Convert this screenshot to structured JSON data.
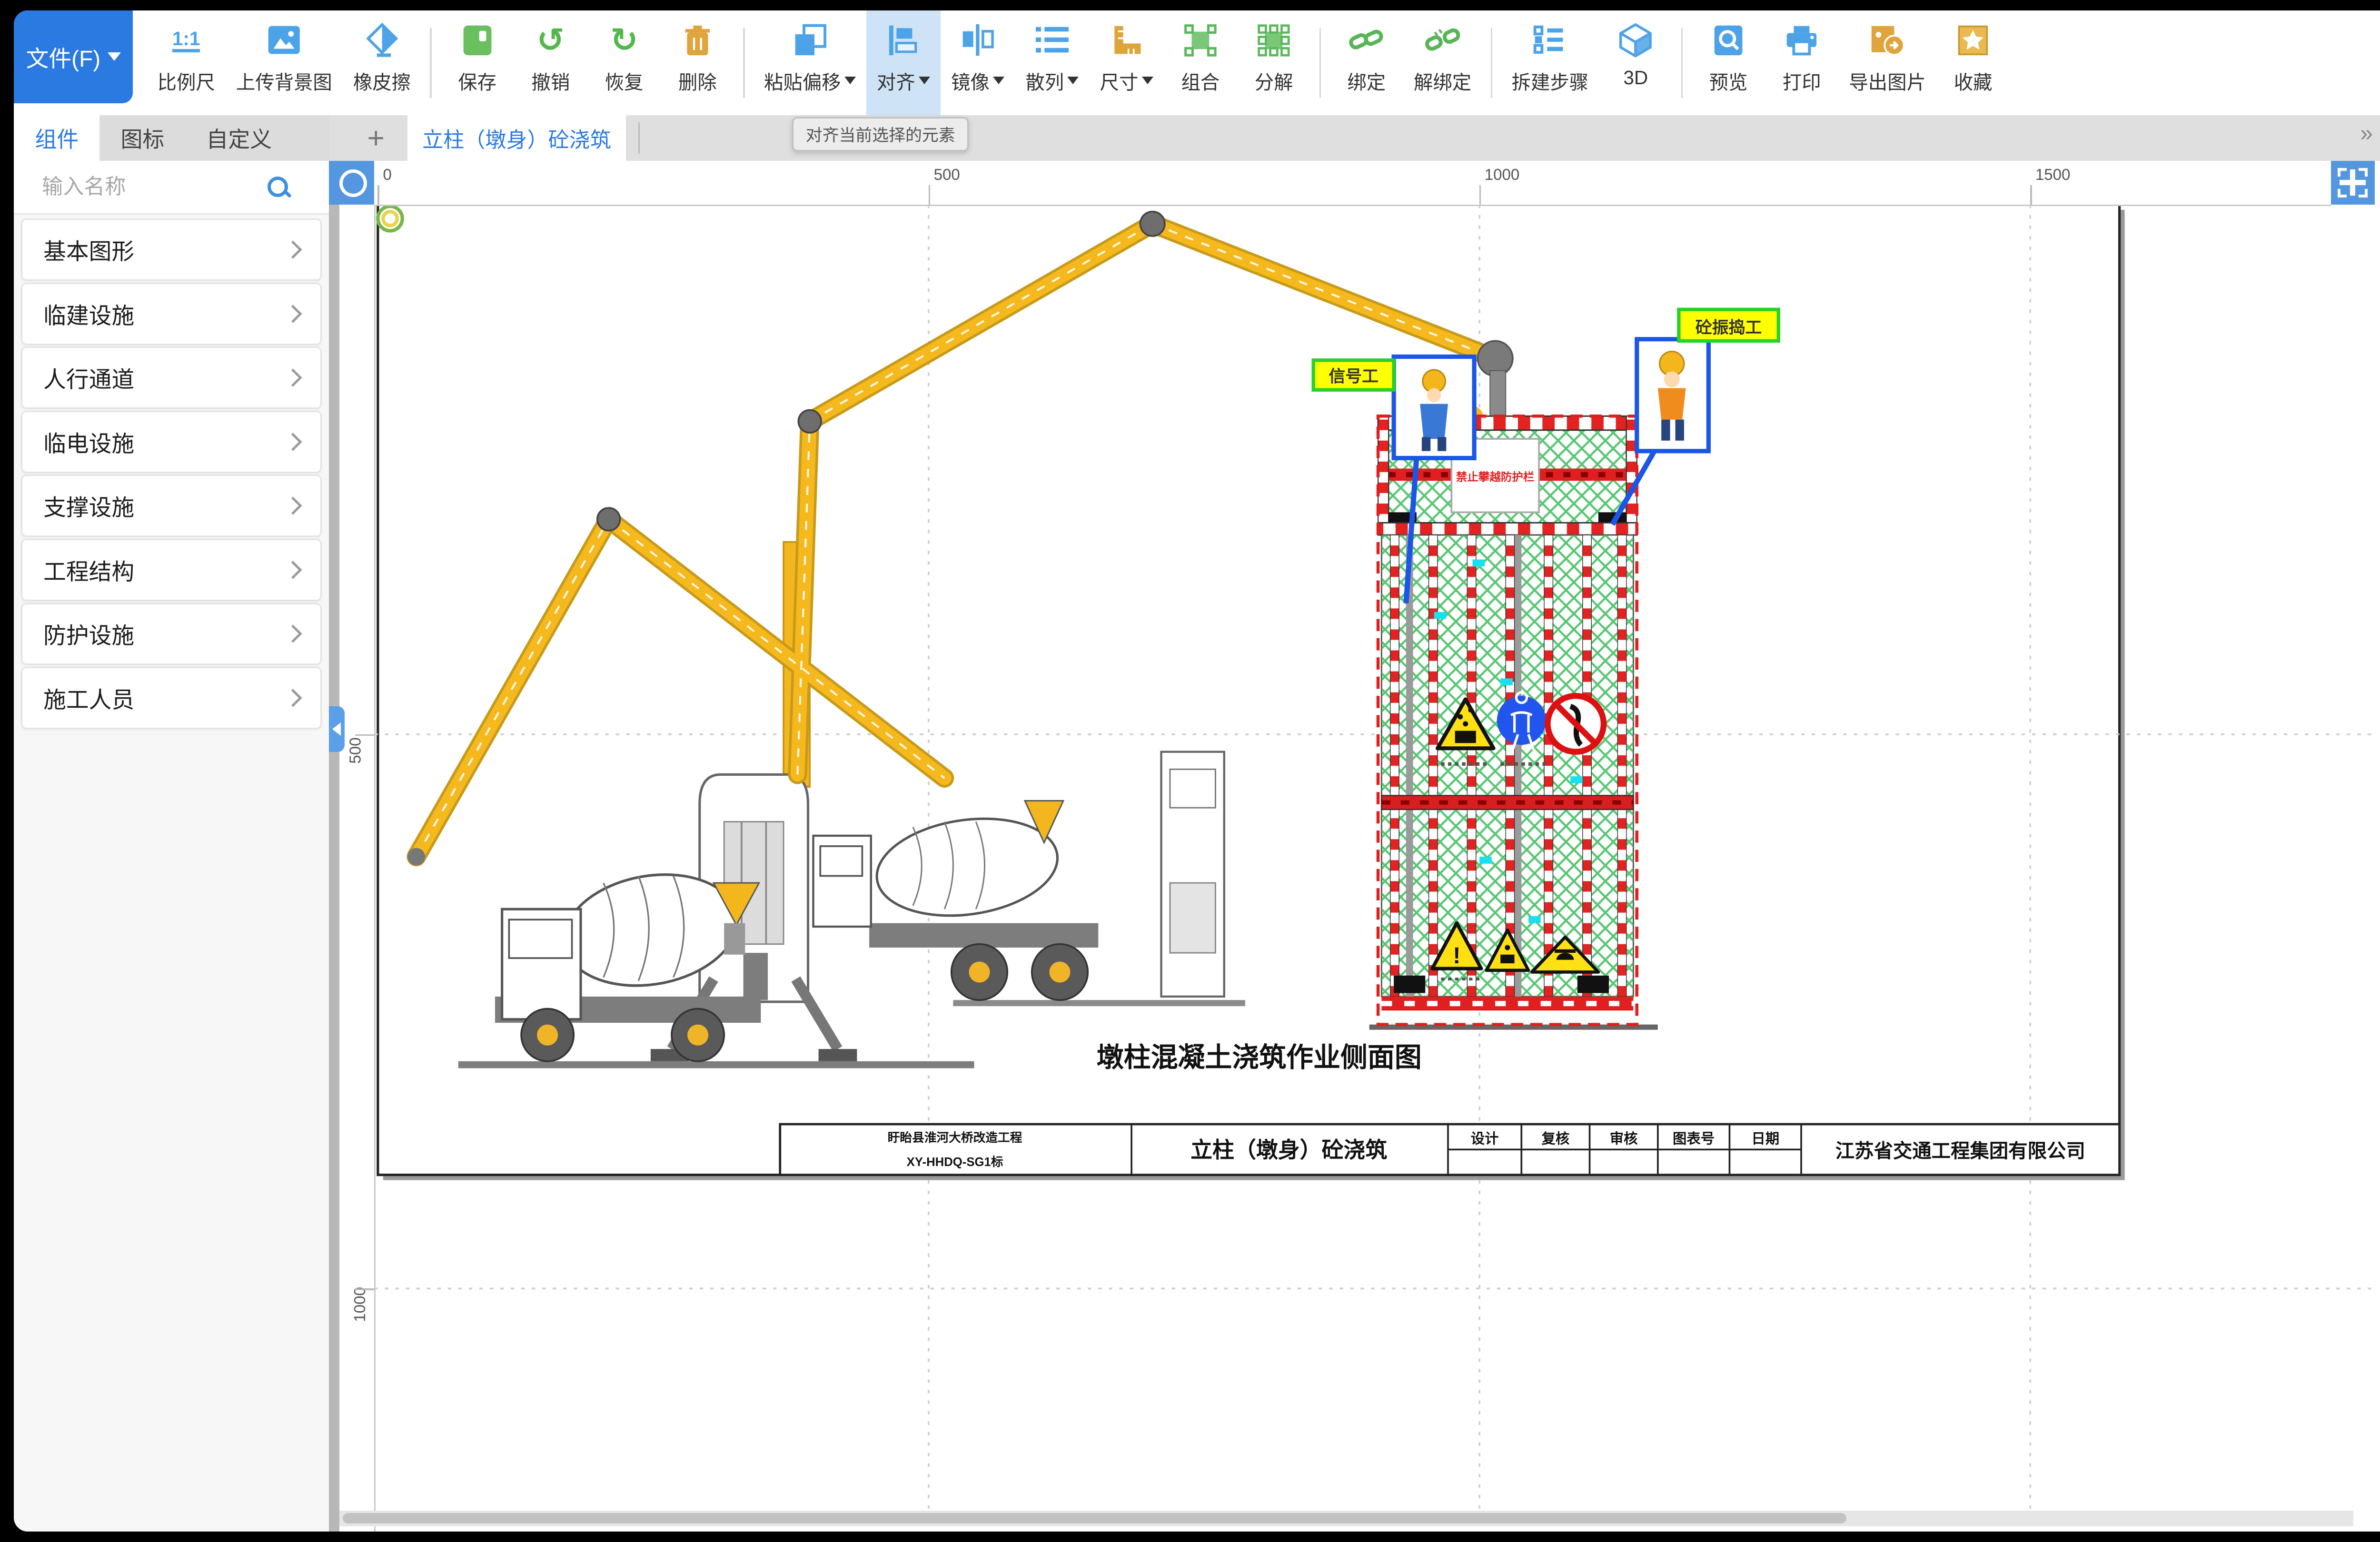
{
  "toolbar": {
    "file_button": "文件(F)",
    "groups": [
      [
        {
          "icon": "scale11",
          "label": "比例尺"
        },
        {
          "icon": "upload-bg",
          "label": "上传背景图"
        },
        {
          "icon": "eraser",
          "label": "橡皮擦"
        }
      ],
      [
        {
          "icon": "save",
          "label": "保存"
        },
        {
          "icon": "undo",
          "label": "撤销"
        },
        {
          "icon": "redo",
          "label": "恢复"
        },
        {
          "icon": "trash",
          "label": "删除"
        }
      ],
      [
        {
          "icon": "paste-offset",
          "label": "粘贴偏移",
          "dropdown": true
        },
        {
          "icon": "align",
          "label": "对齐",
          "dropdown": true,
          "active": true
        },
        {
          "icon": "mirror",
          "label": "镜像",
          "dropdown": true
        },
        {
          "icon": "scatter",
          "label": "散列",
          "dropdown": true
        },
        {
          "icon": "size",
          "label": "尺寸",
          "dropdown": true
        },
        {
          "icon": "group",
          "label": "组合"
        },
        {
          "icon": "ungroup",
          "label": "分解"
        }
      ],
      [
        {
          "icon": "bind",
          "label": "绑定"
        },
        {
          "icon": "unbind",
          "label": "解绑定"
        }
      ],
      [
        {
          "icon": "steps",
          "label": "拆建步骤"
        },
        {
          "icon": "cube",
          "label": "3D"
        }
      ],
      [
        {
          "icon": "preview",
          "label": "预览"
        },
        {
          "icon": "print",
          "label": "打印"
        },
        {
          "icon": "export-image",
          "label": "导出图片"
        },
        {
          "icon": "star",
          "label": "收藏"
        }
      ]
    ]
  },
  "tooltip": "对齐当前选择的元素",
  "sidebar": {
    "tabs": [
      "组件",
      "图标",
      "自定义"
    ],
    "active_tab": "组件",
    "search_placeholder": "输入名称",
    "categories": [
      "基本图形",
      "临建设施",
      "人行通道",
      "临电设施",
      "支撑设施",
      "工程结构",
      "防护设施",
      "施工人员"
    ]
  },
  "canvas": {
    "tab": "立柱（墩身）砼浇筑",
    "add_tab_icon": "+",
    "overflow_icon": "»",
    "h_ruler": [
      "0",
      "500",
      "1000",
      "1500"
    ],
    "v_ruler": [
      "500",
      "1000"
    ]
  },
  "drawing": {
    "title": "墩柱混凝土浇筑作业侧面图",
    "banner": "禁止攀越防护栏",
    "worker_labels": [
      "信号工",
      "砼振捣工"
    ],
    "title_block": {
      "project_line1": "盱眙县淮河大桥改造工程",
      "project_line2": "XY-HHDQ-SG1标",
      "drawing_name": "立柱（墩身）砼浇筑",
      "headers": [
        "设计",
        "复核",
        "审核",
        "图表号",
        "日期"
      ],
      "company": "江苏省交通工程集团有限公司"
    }
  },
  "properties": {
    "tabs": [
      "属性",
      "图层"
    ],
    "active_tab": "属性",
    "rows": [
      {
        "label": "名称",
        "type": "input",
        "value": "背景"
      },
      {
        "label": "锁定",
        "type": "select",
        "value": "否"
      },
      {
        "label": "背景图",
        "type": "select",
        "value": "空"
      },
      {
        "label": "背景图管理",
        "type": "button",
        "value": "操作"
      },
      {
        "label": "适配背景图",
        "type": "select",
        "value": "否"
      },
      {
        "label": "网格吸附",
        "type": "select",
        "value": "否"
      },
      {
        "label": "图层",
        "type": "input",
        "value": "100"
      },
      {
        "label": "比例",
        "type": "input",
        "value": "69.45%"
      },
      {
        "label": "填充颜色",
        "type": "color",
        "value": "#000000"
      },
      {
        "label": "制图框尺寸",
        "type": "select",
        "value": "自定义"
      },
      {
        "label": "边框长度",
        "type": "input",
        "value": "1600"
      },
      {
        "label": "边框高度",
        "type": "input",
        "value": "900"
      },
      {
        "label": "信息框高度",
        "type": "input",
        "value": "50"
      },
      {
        "label": "边框颜色",
        "type": "color",
        "value": "#000000"
      },
      {
        "label": "边框宽度",
        "type": "input",
        "value": "1"
      },
      {
        "label": "字体大小",
        "type": "select",
        "value": "24"
      },
      {
        "label": "字体类型",
        "type": "select",
        "value": "Arial"
      },
      {
        "label": "X轴辅助线",
        "type": "input",
        "value": ""
      },
      {
        "label": "Y轴辅助线",
        "type": "input",
        "value": ""
      }
    ]
  },
  "colors": {
    "accent": "#2a7ae2",
    "icon_blue": "#4da3e8",
    "icon_green": "#5cb84a",
    "icon_orange": "#dfa43c",
    "value_text": "#3d8fe0",
    "mesh_green": "#2eb850",
    "stripe_red": "#e32222"
  }
}
